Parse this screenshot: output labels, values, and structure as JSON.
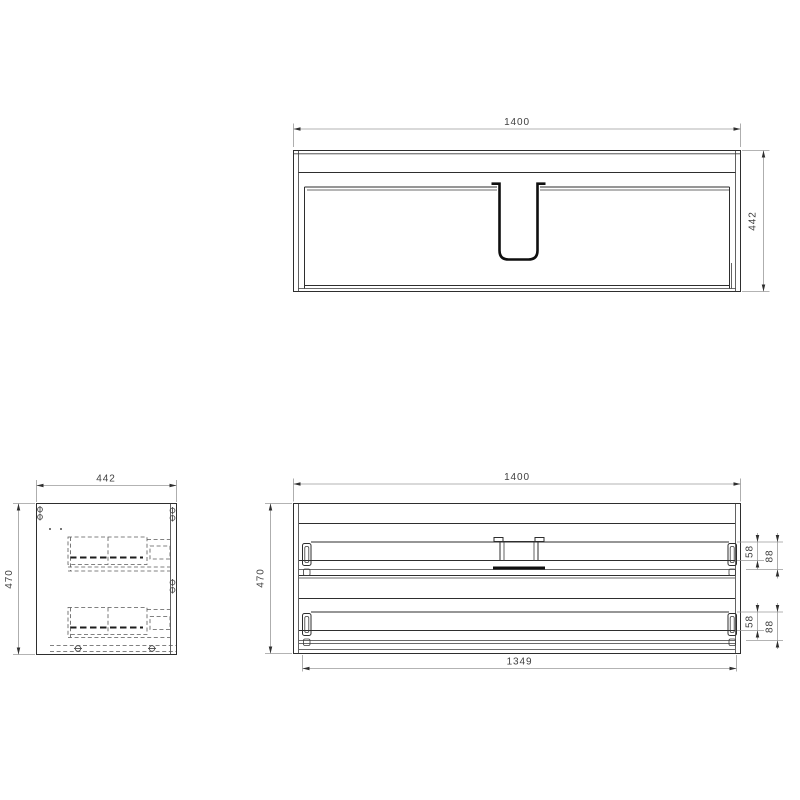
{
  "drawing": {
    "kind": "furniture-technical-drawing",
    "background_color": "#ffffff",
    "line_color": "#2e2e2e",
    "dimension_line_color": "#9a9a9a",
    "text_color": "#3f3f3f",
    "views": {
      "top": {
        "dim_width": "1400",
        "dim_depth": "442"
      },
      "side": {
        "dim_width": "442",
        "dim_height": "470"
      },
      "front": {
        "dim_width": "1400",
        "dim_height": "470",
        "dim_inner_width": "1349",
        "top_drawer": {
          "dim_slide_height": "58",
          "dim_back_height": "88"
        },
        "bottom_drawer": {
          "dim_slide_height": "58",
          "dim_back_height": "88"
        }
      }
    }
  }
}
